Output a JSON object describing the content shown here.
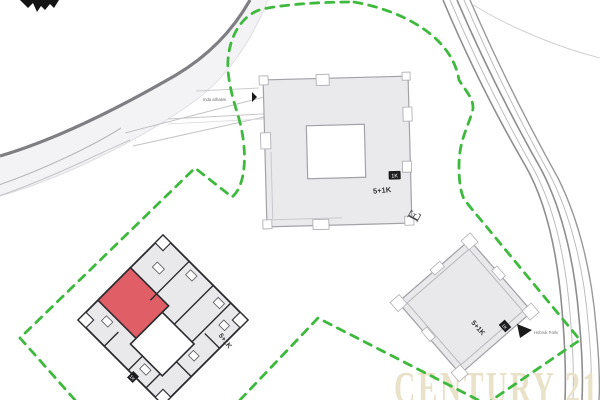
{
  "plan": {
    "kind": "residential site plan",
    "compass_icon": "north-arrow"
  },
  "watermark": {
    "text": "CENTURY 21",
    "color": "#eae2c8"
  },
  "boundary": {
    "style": "dashed",
    "color": "#3eb93e"
  },
  "colors": {
    "building_fill": "#e9e9ec",
    "building_stroke_light": "#a2a2a8",
    "building_stroke_dark": "#2b2b2f",
    "unit_highlight_red": "#e05e66",
    "road_edge_dark": "#7f7f83",
    "road_fill": "#f3f3f5",
    "road_line_light": "#b8b8bc",
    "label_text": "#333333"
  },
  "buildings": {
    "top": {
      "type_label": "5+1K",
      "chip": "1K"
    },
    "left": {
      "type_label": "5+1K",
      "chip": "1K",
      "highlighted_unit": "red"
    },
    "right": {
      "type_label": "5+1K",
      "chip": "1K"
    }
  },
  "annotations": {
    "driveway_note": "mda arhatvn",
    "road_note": "Hobruk Parkı",
    "scribble": "E"
  }
}
